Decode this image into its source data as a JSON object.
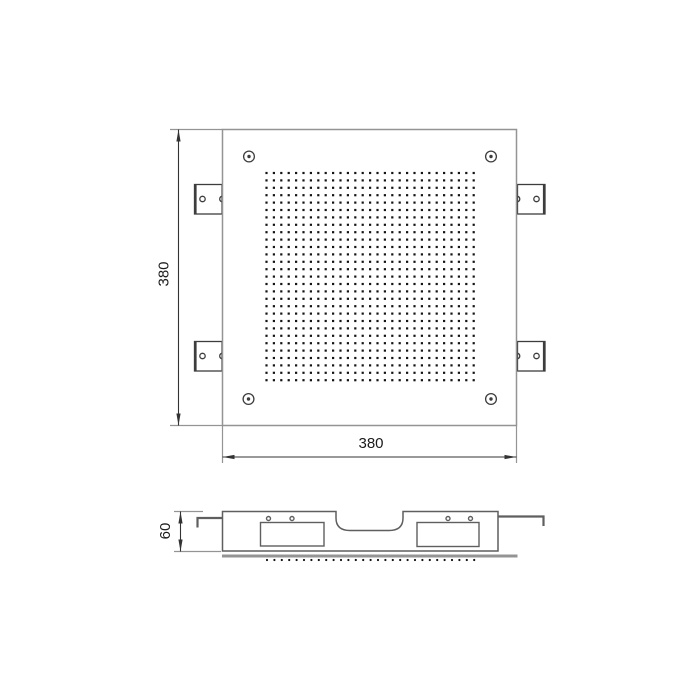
{
  "labels": {
    "top_width": "380",
    "top_height": "380",
    "side_height": "60"
  },
  "colors": {
    "background": "#ffffff",
    "outline_light": "#949494",
    "outline_dark": "#3d3d3d",
    "body_line": "#5f5f5f",
    "dot": "#141414",
    "dimension": "#333333",
    "text": "#1a1a1a"
  },
  "perforation_grid": {
    "rows": 29,
    "cols": 29,
    "start_x": 266.5,
    "start_y": 173,
    "spacing_x": 7.4,
    "spacing_y": 7.4,
    "dot_size": 2.2
  },
  "nozzle_row": {
    "count": 29,
    "start_x": 267,
    "spacing": 7.4,
    "y": 560,
    "radius": 1.1
  }
}
